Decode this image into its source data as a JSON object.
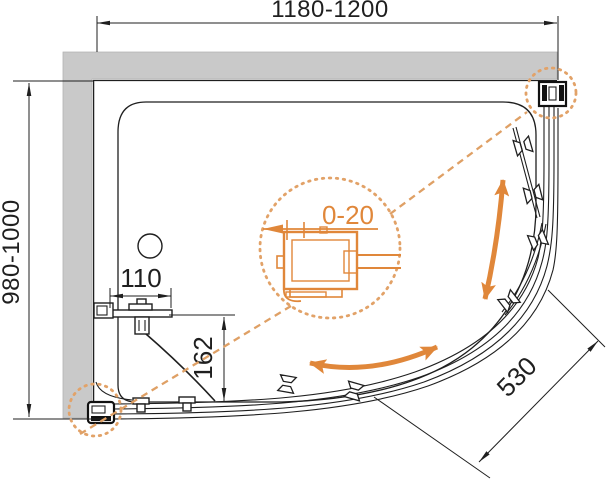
{
  "title": "shower-enclosure-plan-technical-drawing",
  "dimensions": {
    "width_range": "1180-1200",
    "depth_range": "980-1000",
    "profile_adjustment_range": "0-20",
    "wall_bracket_offset": "110",
    "bracket_to_rail_drop": "162",
    "front_arc_radius": "530"
  },
  "colors": {
    "accent_orange": "#e0873a",
    "callout_dot_orange": "#e2a268",
    "leader_dash_orange": "#dfa065",
    "wall_gray": "#c9c9c9",
    "line_black": "#1f1f1f"
  }
}
